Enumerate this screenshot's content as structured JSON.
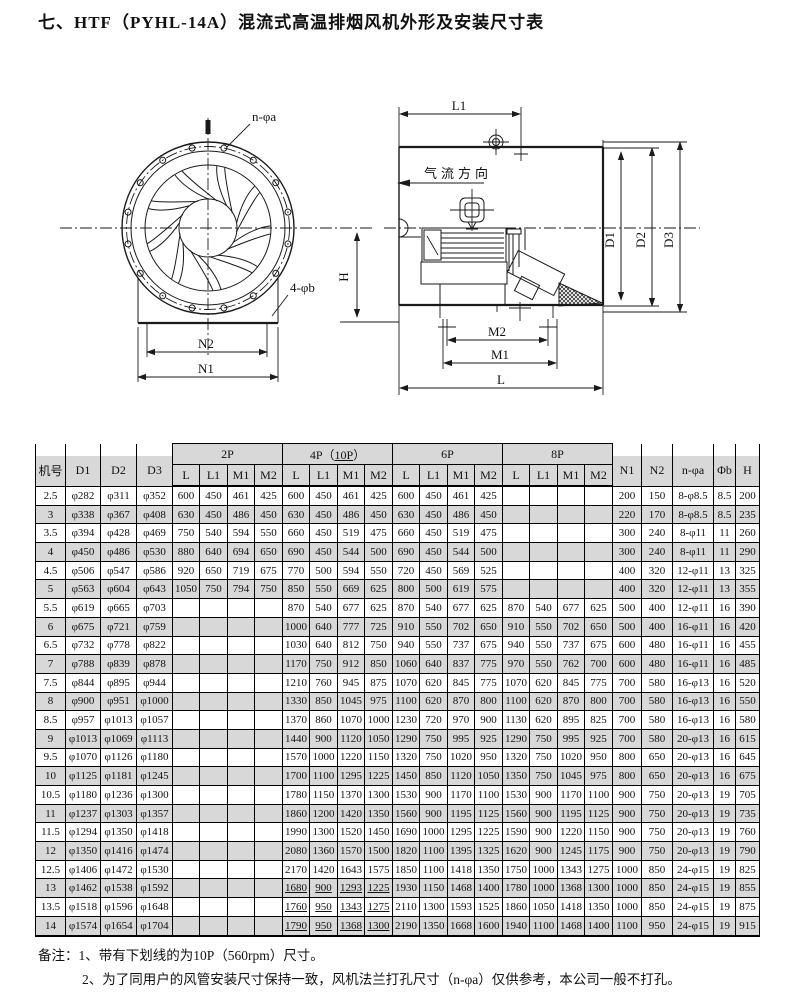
{
  "title": "七、HTF（PYHL-14A）混流式高温排烟风机外形及安装尺寸表",
  "colors": {
    "row_shade": "#d8d8d8",
    "ink": "#111111"
  },
  "diagram": {
    "front_view": {
      "bolt_holes_label": "n-φa",
      "base_holes_label": "4-φb",
      "dim_n2": "N2",
      "dim_n1": "N1"
    },
    "side_view": {
      "dim_l1": "L1",
      "airflow_label": "气流方向",
      "dim_h": "H",
      "dim_d1": "D1",
      "dim_d2": "D2",
      "dim_d3": "D3",
      "dim_m2": "M2",
      "dim_m1": "M1",
      "dim_l": "L"
    }
  },
  "table": {
    "header": {
      "model": "机号",
      "d1": "D1",
      "d2": "D2",
      "d3": "D3",
      "group_2p": "2P",
      "group_4p_prefix": "4P（",
      "group_4p_underlined": "10P",
      "group_4p_suffix": "）",
      "group_6p": "6P",
      "group_8p": "8P",
      "sub": [
        "L",
        "L1",
        "M1",
        "M2"
      ],
      "n1": "N1",
      "n2": "N2",
      "bolt_pattern": "n-φa",
      "phi_b": "Φb",
      "h": "H"
    },
    "rows": [
      {
        "model": "2.5",
        "d1": "φ282",
        "d2": "φ311",
        "d3": "φ352",
        "p2": [
          "600",
          "450",
          "461",
          "425"
        ],
        "p4": [
          "600",
          "450",
          "461",
          "425"
        ],
        "p6": [
          "600",
          "450",
          "461",
          "425"
        ],
        "p8": [
          "",
          "",
          "",
          ""
        ],
        "n1": "200",
        "n2": "150",
        "na": "8-φ8.5",
        "b": "8.5",
        "h": "200"
      },
      {
        "model": "3",
        "d1": "φ338",
        "d2": "φ367",
        "d3": "φ408",
        "p2": [
          "630",
          "450",
          "486",
          "450"
        ],
        "p4": [
          "630",
          "450",
          "486",
          "450"
        ],
        "p6": [
          "630",
          "450",
          "486",
          "450"
        ],
        "p8": [
          "",
          "",
          "",
          ""
        ],
        "n1": "220",
        "n2": "170",
        "na": "8-φ8.5",
        "b": "8.5",
        "h": "235"
      },
      {
        "model": "3.5",
        "d1": "φ394",
        "d2": "φ428",
        "d3": "φ469",
        "p2": [
          "750",
          "540",
          "594",
          "550"
        ],
        "p4": [
          "660",
          "450",
          "519",
          "475"
        ],
        "p6": [
          "660",
          "450",
          "519",
          "475"
        ],
        "p8": [
          "",
          "",
          "",
          ""
        ],
        "n1": "300",
        "n2": "240",
        "na": "8-φ11",
        "b": "11",
        "h": "260"
      },
      {
        "model": "4",
        "d1": "φ450",
        "d2": "φ486",
        "d3": "φ530",
        "p2": [
          "880",
          "640",
          "694",
          "650"
        ],
        "p4": [
          "690",
          "450",
          "544",
          "500"
        ],
        "p6": [
          "690",
          "450",
          "544",
          "500"
        ],
        "p8": [
          "",
          "",
          "",
          ""
        ],
        "n1": "300",
        "n2": "240",
        "na": "8-φ11",
        "b": "11",
        "h": "290"
      },
      {
        "model": "4.5",
        "d1": "φ506",
        "d2": "φ547",
        "d3": "φ586",
        "p2": [
          "920",
          "650",
          "719",
          "675"
        ],
        "p4": [
          "770",
          "500",
          "594",
          "550"
        ],
        "p6": [
          "720",
          "450",
          "569",
          "525"
        ],
        "p8": [
          "",
          "",
          "",
          ""
        ],
        "n1": "400",
        "n2": "320",
        "na": "12-φ11",
        "b": "13",
        "h": "325"
      },
      {
        "model": "5",
        "d1": "φ563",
        "d2": "φ604",
        "d3": "φ643",
        "p2": [
          "1050",
          "750",
          "794",
          "750"
        ],
        "p4": [
          "850",
          "550",
          "669",
          "625"
        ],
        "p6": [
          "800",
          "500",
          "619",
          "575"
        ],
        "p8": [
          "",
          "",
          "",
          ""
        ],
        "n1": "400",
        "n2": "320",
        "na": "12-φ11",
        "b": "13",
        "h": "355"
      },
      {
        "model": "5.5",
        "d1": "φ619",
        "d2": "φ665",
        "d3": "φ703",
        "p2": [
          "",
          "",
          "",
          ""
        ],
        "p4": [
          "870",
          "540",
          "677",
          "625"
        ],
        "p6": [
          "870",
          "540",
          "677",
          "625"
        ],
        "p8": [
          "870",
          "540",
          "677",
          "625"
        ],
        "n1": "500",
        "n2": "400",
        "na": "12-φ11",
        "b": "16",
        "h": "390"
      },
      {
        "model": "6",
        "d1": "φ675",
        "d2": "φ721",
        "d3": "φ759",
        "p2": [
          "",
          "",
          "",
          ""
        ],
        "p4": [
          "1000",
          "640",
          "777",
          "725"
        ],
        "p6": [
          "910",
          "550",
          "702",
          "650"
        ],
        "p8": [
          "910",
          "550",
          "702",
          "650"
        ],
        "n1": "500",
        "n2": "400",
        "na": "16-φ11",
        "b": "16",
        "h": "420"
      },
      {
        "model": "6.5",
        "d1": "φ732",
        "d2": "φ778",
        "d3": "φ822",
        "p2": [
          "",
          "",
          "",
          ""
        ],
        "p4": [
          "1030",
          "640",
          "812",
          "750"
        ],
        "p6": [
          "940",
          "550",
          "737",
          "675"
        ],
        "p8": [
          "940",
          "550",
          "737",
          "675"
        ],
        "n1": "600",
        "n2": "480",
        "na": "16-φ11",
        "b": "16",
        "h": "455"
      },
      {
        "model": "7",
        "d1": "φ788",
        "d2": "φ839",
        "d3": "φ878",
        "p2": [
          "",
          "",
          "",
          ""
        ],
        "p4": [
          "1170",
          "750",
          "912",
          "850"
        ],
        "p6": [
          "1060",
          "640",
          "837",
          "775"
        ],
        "p8": [
          "970",
          "550",
          "762",
          "700"
        ],
        "n1": "600",
        "n2": "480",
        "na": "16-φ11",
        "b": "16",
        "h": "485"
      },
      {
        "model": "7.5",
        "d1": "φ844",
        "d2": "φ895",
        "d3": "φ944",
        "p2": [
          "",
          "",
          "",
          ""
        ],
        "p4": [
          "1210",
          "760",
          "945",
          "875"
        ],
        "p6": [
          "1070",
          "620",
          "845",
          "775"
        ],
        "p8": [
          "1070",
          "620",
          "845",
          "775"
        ],
        "n1": "700",
        "n2": "580",
        "na": "16-φ13",
        "b": "16",
        "h": "520"
      },
      {
        "model": "8",
        "d1": "φ900",
        "d2": "φ951",
        "d3": "φ1000",
        "p2": [
          "",
          "",
          "",
          ""
        ],
        "p4": [
          "1330",
          "850",
          "1045",
          "975"
        ],
        "p6": [
          "1100",
          "620",
          "870",
          "800"
        ],
        "p8": [
          "1100",
          "620",
          "870",
          "800"
        ],
        "n1": "700",
        "n2": "580",
        "na": "16-φ13",
        "b": "16",
        "h": "550"
      },
      {
        "model": "8.5",
        "d1": "φ957",
        "d2": "φ1013",
        "d3": "φ1057",
        "p2": [
          "",
          "",
          "",
          ""
        ],
        "p4": [
          "1370",
          "860",
          "1070",
          "1000"
        ],
        "p6": [
          "1230",
          "720",
          "970",
          "900"
        ],
        "p8": [
          "1130",
          "620",
          "895",
          "825"
        ],
        "n1": "700",
        "n2": "580",
        "na": "16-φ13",
        "b": "16",
        "h": "580"
      },
      {
        "model": "9",
        "d1": "φ1013",
        "d2": "φ1069",
        "d3": "φ1113",
        "p2": [
          "",
          "",
          "",
          ""
        ],
        "p4": [
          "1440",
          "900",
          "1120",
          "1050"
        ],
        "p6": [
          "1290",
          "750",
          "995",
          "925"
        ],
        "p8": [
          "1290",
          "750",
          "995",
          "925"
        ],
        "n1": "700",
        "n2": "580",
        "na": "20-φ13",
        "b": "16",
        "h": "615"
      },
      {
        "model": "9.5",
        "d1": "φ1070",
        "d2": "φ1126",
        "d3": "φ1180",
        "p2": [
          "",
          "",
          "",
          ""
        ],
        "p4": [
          "1570",
          "1000",
          "1220",
          "1150"
        ],
        "p6": [
          "1320",
          "750",
          "1020",
          "950"
        ],
        "p8": [
          "1320",
          "750",
          "1020",
          "950"
        ],
        "n1": "800",
        "n2": "650",
        "na": "20-φ13",
        "b": "16",
        "h": "645"
      },
      {
        "model": "10",
        "d1": "φ1125",
        "d2": "φ1181",
        "d3": "φ1245",
        "p2": [
          "",
          "",
          "",
          ""
        ],
        "p4": [
          "1700",
          "1100",
          "1295",
          "1225"
        ],
        "p6": [
          "1450",
          "850",
          "1120",
          "1050"
        ],
        "p8": [
          "1350",
          "750",
          "1045",
          "975"
        ],
        "n1": "800",
        "n2": "650",
        "na": "20-φ13",
        "b": "16",
        "h": "675"
      },
      {
        "model": "10.5",
        "d1": "φ1180",
        "d2": "φ1236",
        "d3": "φ1300",
        "p2": [
          "",
          "",
          "",
          ""
        ],
        "p4": [
          "1780",
          "1150",
          "1370",
          "1300"
        ],
        "p6": [
          "1530",
          "900",
          "1170",
          "1100"
        ],
        "p8": [
          "1530",
          "900",
          "1170",
          "1100"
        ],
        "n1": "900",
        "n2": "750",
        "na": "20-φ13",
        "b": "19",
        "h": "705"
      },
      {
        "model": "11",
        "d1": "φ1237",
        "d2": "φ1303",
        "d3": "φ1357",
        "p2": [
          "",
          "",
          "",
          ""
        ],
        "p4": [
          "1860",
          "1200",
          "1420",
          "1350"
        ],
        "p6": [
          "1560",
          "900",
          "1195",
          "1125"
        ],
        "p8": [
          "1560",
          "900",
          "1195",
          "1125"
        ],
        "n1": "900",
        "n2": "750",
        "na": "20-φ13",
        "b": "19",
        "h": "735"
      },
      {
        "model": "11.5",
        "d1": "φ1294",
        "d2": "φ1350",
        "d3": "φ1418",
        "p2": [
          "",
          "",
          "",
          ""
        ],
        "p4": [
          "1990",
          "1300",
          "1520",
          "1450"
        ],
        "p6": [
          "1690",
          "1000",
          "1295",
          "1225"
        ],
        "p8": [
          "1590",
          "900",
          "1220",
          "1150"
        ],
        "n1": "900",
        "n2": "750",
        "na": "20-φ13",
        "b": "19",
        "h": "760"
      },
      {
        "model": "12",
        "d1": "φ1350",
        "d2": "φ1416",
        "d3": "φ1474",
        "p2": [
          "",
          "",
          "",
          ""
        ],
        "p4": [
          "2080",
          "1360",
          "1570",
          "1500"
        ],
        "p6": [
          "1820",
          "1100",
          "1395",
          "1325"
        ],
        "p8": [
          "1620",
          "900",
          "1245",
          "1175"
        ],
        "n1": "900",
        "n2": "750",
        "na": "20-φ13",
        "b": "19",
        "h": "790"
      },
      {
        "model": "12.5",
        "d1": "φ1406",
        "d2": "φ1472",
        "d3": "φ1530",
        "p2": [
          "",
          "",
          "",
          ""
        ],
        "p4": [
          "2170",
          "1420",
          "1643",
          "1575"
        ],
        "p6": [
          "1850",
          "1100",
          "1418",
          "1350"
        ],
        "p8": [
          "1750",
          "1000",
          "1343",
          "1275"
        ],
        "n1": "1000",
        "n2": "850",
        "na": "24-φ15",
        "b": "19",
        "h": "825"
      },
      {
        "model": "13",
        "d1": "φ1462",
        "d2": "φ1538",
        "d3": "φ1592",
        "u10": true,
        "p2": [
          "",
          "",
          "",
          ""
        ],
        "p4": [
          "1680",
          "900",
          "1293",
          "1225"
        ],
        "p6": [
          "1930",
          "1150",
          "1468",
          "1400"
        ],
        "p8": [
          "1780",
          "1000",
          "1368",
          "1300"
        ],
        "n1": "1000",
        "n2": "850",
        "na": "24-φ15",
        "b": "19",
        "h": "855"
      },
      {
        "model": "13.5",
        "d1": "φ1518",
        "d2": "φ1596",
        "d3": "φ1648",
        "u10": true,
        "p2": [
          "",
          "",
          "",
          ""
        ],
        "p4": [
          "1760",
          "950",
          "1343",
          "1275"
        ],
        "p6": [
          "2110",
          "1300",
          "1593",
          "1525"
        ],
        "p8": [
          "1860",
          "1050",
          "1418",
          "1350"
        ],
        "n1": "1000",
        "n2": "850",
        "na": "24-φ15",
        "b": "19",
        "h": "875"
      },
      {
        "model": "14",
        "d1": "φ1574",
        "d2": "φ1654",
        "d3": "φ1704",
        "u10": true,
        "p2": [
          "",
          "",
          "",
          ""
        ],
        "p4": [
          "1790",
          "950",
          "1368",
          "1300"
        ],
        "p6": [
          "2190",
          "1350",
          "1668",
          "1600"
        ],
        "p8": [
          "1940",
          "1100",
          "1468",
          "1400"
        ],
        "n1": "1100",
        "n2": "950",
        "na": "24-φ15",
        "b": "19",
        "h": "915"
      }
    ]
  },
  "notes": {
    "label": "备注：",
    "note1": "1、带有下划线的为10P（560rpm）尺寸。",
    "note2": "2、为了同用户的风管安装尺寸保持一致，风机法兰打孔尺寸（n-φa）仅供参考，本公司一般不打孔。"
  }
}
